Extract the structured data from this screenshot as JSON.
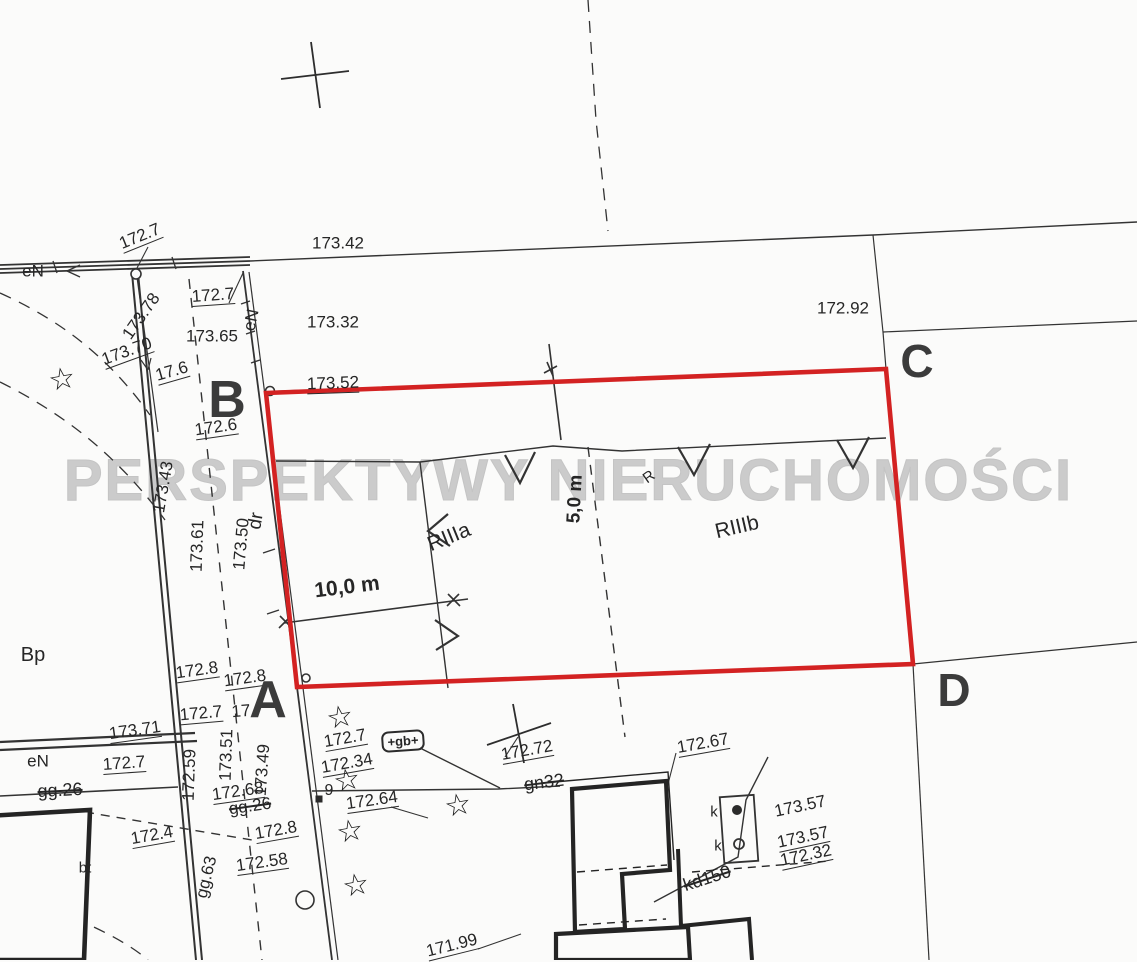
{
  "map": {
    "watermark": "PERSPEKTYWY NIERUCHOMOŚCI",
    "colors": {
      "boundary_red": "#d32222",
      "ink": "#2b2b2b",
      "watermark_gray": "#cbcbcb"
    },
    "corner_letters": [
      {
        "t": "B",
        "x": 227,
        "y": 400,
        "size": 52
      },
      {
        "t": "A",
        "x": 268,
        "y": 700,
        "size": 52
      },
      {
        "t": "C",
        "x": 917,
        "y": 361,
        "size": 46
      },
      {
        "t": "D",
        "x": 954,
        "y": 690,
        "size": 46
      }
    ],
    "labels": [
      {
        "t": "172.7",
        "x": 140,
        "y": 237,
        "r": -22,
        "u": 1
      },
      {
        "t": "173.42",
        "x": 338,
        "y": 243
      },
      {
        "t": "eN",
        "x": 33,
        "y": 271
      },
      {
        "t": "172.7",
        "x": 213,
        "y": 296,
        "r": -4,
        "u": 1
      },
      {
        "t": "173.32",
        "x": 333,
        "y": 322
      },
      {
        "t": "172.92",
        "x": 843,
        "y": 308
      },
      {
        "t": "173.78",
        "x": 141,
        "y": 316,
        "r": -55
      },
      {
        "t": "173.65",
        "x": 212,
        "y": 336
      },
      {
        "t": "173.70",
        "x": 127,
        "y": 352,
        "r": -20,
        "u": 1
      },
      {
        "t": "17.6",
        "x": 172,
        "y": 372,
        "r": -16,
        "u": 1
      },
      {
        "t": "173.52",
        "x": 333,
        "y": 384,
        "r": -2,
        "u": 1
      },
      {
        "t": "172.6",
        "x": 216,
        "y": 428,
        "r": -8,
        "u": 1
      },
      {
        "t": "eN",
        "x": 251,
        "y": 320,
        "r": -78
      },
      {
        "t": "173.43",
        "x": 163,
        "y": 487,
        "r": -80
      },
      {
        "t": "173.61",
        "x": 197,
        "y": 546,
        "r": -88
      },
      {
        "t": "173.50",
        "x": 241,
        "y": 544,
        "r": -85
      },
      {
        "t": "dr",
        "x": 256,
        "y": 521,
        "r": -80,
        "size": 19
      },
      {
        "t": "RIIIa",
        "x": 449,
        "y": 537,
        "r": -22,
        "size": 21
      },
      {
        "t": "RIIIb",
        "x": 737,
        "y": 527,
        "r": -13,
        "size": 21
      },
      {
        "t": "R",
        "x": 649,
        "y": 477,
        "r": -35,
        "size": 15
      },
      {
        "t": "5,0 m",
        "x": 575,
        "y": 499,
        "r": -87,
        "size": 19,
        "w": 600
      },
      {
        "t": "10,0 m",
        "x": 347,
        "y": 587,
        "r": -7,
        "size": 21,
        "w": 700
      },
      {
        "t": "Bp",
        "x": 33,
        "y": 655,
        "size": 20
      },
      {
        "t": "172.8",
        "x": 197,
        "y": 671,
        "r": -8,
        "u": 1
      },
      {
        "t": "172.8",
        "x": 245,
        "y": 679,
        "r": -8,
        "u": 1
      },
      {
        "t": "172.7",
        "x": 201,
        "y": 714,
        "r": -5,
        "u": 1
      },
      {
        "t": "17",
        "x": 241,
        "y": 711,
        "r": -5
      },
      {
        "t": "173.71",
        "x": 135,
        "y": 731,
        "r": -8,
        "u": 1
      },
      {
        "t": "172.59",
        "x": 189,
        "y": 775,
        "r": -88
      },
      {
        "t": "173.51",
        "x": 226,
        "y": 755,
        "r": -88
      },
      {
        "t": "173.49",
        "x": 262,
        "y": 770,
        "r": -86
      },
      {
        "t": "eN",
        "x": 38,
        "y": 761
      },
      {
        "t": "172.7",
        "x": 124,
        "y": 764,
        "r": -4,
        "u": 1
      },
      {
        "t": "gg.26",
        "x": 60,
        "y": 790,
        "r": -3,
        "s": 1,
        "size": 18
      },
      {
        "t": "172.4",
        "x": 152,
        "y": 836,
        "r": -10,
        "u": 1
      },
      {
        "t": "bt",
        "x": 85,
        "y": 868,
        "size": 15
      },
      {
        "t": "172.68",
        "x": 238,
        "y": 792,
        "r": -8,
        "u": 1
      },
      {
        "t": "gg.26",
        "x": 250,
        "y": 806,
        "r": -8,
        "s": 1
      },
      {
        "t": "9",
        "x": 329,
        "y": 791,
        "size": 16
      },
      {
        "t": "172.64",
        "x": 372,
        "y": 801,
        "r": -8,
        "u": 1
      },
      {
        "t": "172.8",
        "x": 276,
        "y": 831,
        "r": -10,
        "u": 1
      },
      {
        "t": "172.58",
        "x": 262,
        "y": 863,
        "r": -8,
        "u": 1
      },
      {
        "t": "gg.63",
        "x": 206,
        "y": 877,
        "r": -76
      },
      {
        "t": "172.7",
        "x": 345,
        "y": 739,
        "r": -10,
        "u": 1
      },
      {
        "t": "172.34",
        "x": 347,
        "y": 764,
        "r": -10,
        "u": 1
      },
      {
        "t": "+gb+",
        "x": 403,
        "y": 741,
        "r": -4,
        "box": 1,
        "size": 13
      },
      {
        "t": "172.72",
        "x": 527,
        "y": 751,
        "r": -10,
        "u": 1
      },
      {
        "t": "gn32",
        "x": 544,
        "y": 782,
        "r": -7,
        "s": 1,
        "size": 18
      },
      {
        "t": "172.67",
        "x": 703,
        "y": 744,
        "r": -10,
        "u": 1
      },
      {
        "t": "k",
        "x": 714,
        "y": 812,
        "size": 15
      },
      {
        "t": "k",
        "x": 718,
        "y": 846,
        "size": 15
      },
      {
        "t": "173.57",
        "x": 800,
        "y": 806,
        "r": -12
      },
      {
        "t": "173.57",
        "x": 803,
        "y": 838,
        "r": -12,
        "u": 1
      },
      {
        "t": "172.32",
        "x": 806,
        "y": 856,
        "r": -12,
        "u": 1
      },
      {
        "t": "kd150",
        "x": 707,
        "y": 878,
        "r": -18,
        "s": 1,
        "size": 18
      },
      {
        "t": "171.99",
        "x": 452,
        "y": 946,
        "r": -14,
        "u": 1
      }
    ],
    "stars": [
      [
        62,
        380
      ],
      [
        340,
        718
      ],
      [
        347,
        781
      ],
      [
        350,
        832
      ],
      [
        356,
        886
      ],
      [
        458,
        806
      ]
    ]
  }
}
